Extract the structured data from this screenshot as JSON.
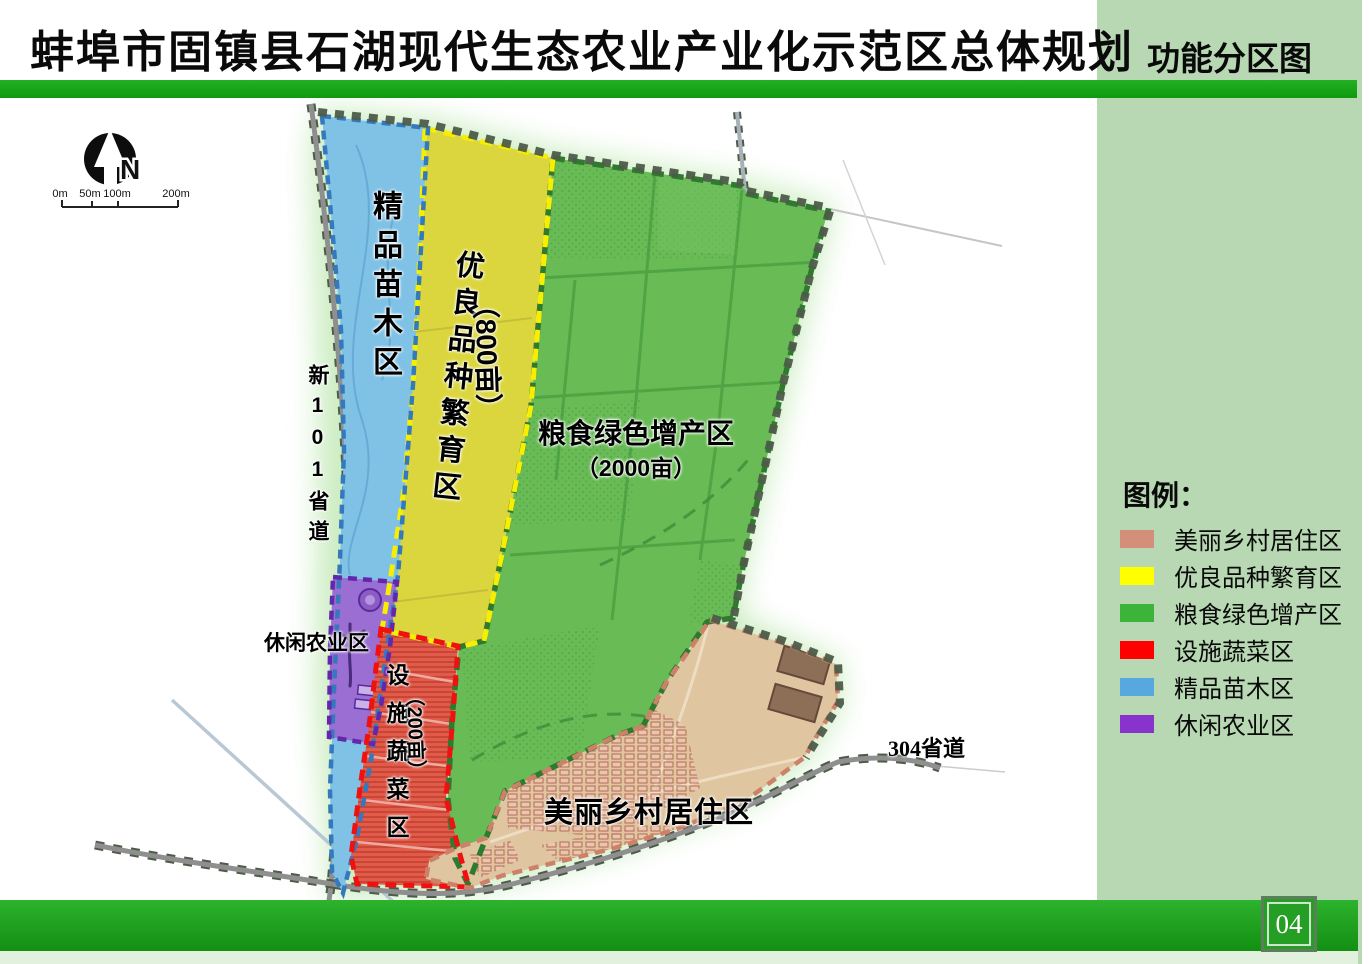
{
  "header": {
    "title": "蚌埠市固镇县石湖现代生态农业产业化示范区总体规划",
    "corner_title": "功能分区图",
    "page_number": "04"
  },
  "map": {
    "zones": {
      "nursery": {
        "label": "精品苗木区"
      },
      "breeding": {
        "label": "优良品种繁育区",
        "area": "（800亩）"
      },
      "grain": {
        "label": "粮食绿色增产区",
        "area": "（2000亩）"
      },
      "vegetable": {
        "label": "设施蔬菜区",
        "area": "（200亩）"
      },
      "leisure": {
        "label": "休闲农业区"
      },
      "village": {
        "label": "美丽乡村居住区"
      }
    },
    "roads": {
      "west": "新101省道",
      "south": "304省道"
    },
    "compass": "N",
    "scale": {
      "t0": "0m",
      "t1": "50m",
      "t2": "100m",
      "t3": "200m"
    }
  },
  "legend": {
    "title": "图例：",
    "items": [
      {
        "label": "美丽乡村居住区",
        "color": "#d48f7b"
      },
      {
        "label": "优良品种繁育区",
        "color": "#ffff00"
      },
      {
        "label": "粮食绿色增产区",
        "color": "#3cb43a"
      },
      {
        "label": "设施蔬菜区",
        "color": "#ff0000"
      },
      {
        "label": "精品苗木区",
        "color": "#58a8e0"
      },
      {
        "label": "休闲农业区",
        "color": "#8833cc"
      }
    ]
  }
}
